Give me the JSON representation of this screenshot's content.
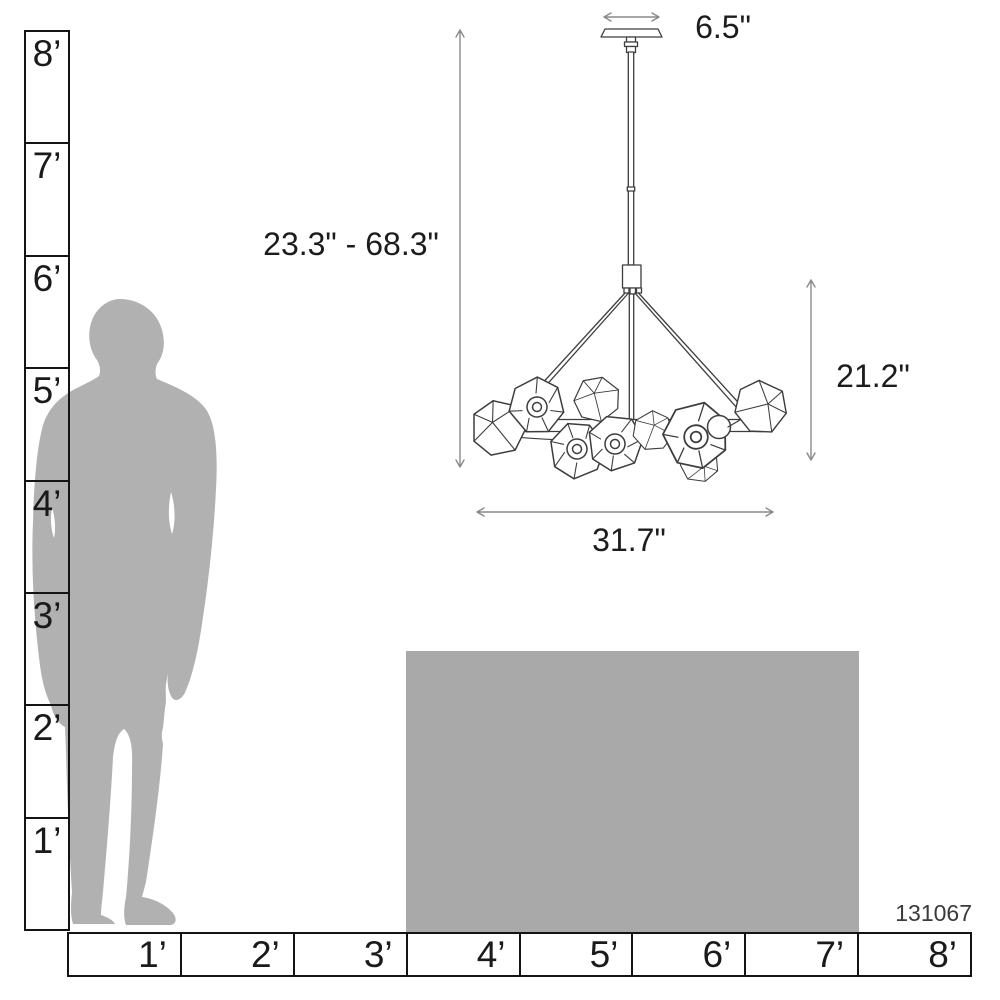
{
  "product": {
    "code": "131067"
  },
  "dimension_labels": {
    "canopy_width": "6.5\"",
    "overall_height_range": "23.3\" - 68.3\"",
    "body_height": "21.2\"",
    "body_width": "31.7\""
  },
  "vertical_ruler": {
    "labels": [
      "8’",
      "7’",
      "6’",
      "5’",
      "4’",
      "3’",
      "2’",
      "1’"
    ]
  },
  "horizontal_ruler": {
    "labels": [
      "1’",
      "2’",
      "3’",
      "4’",
      "5’",
      "6’",
      "7’",
      "8’"
    ]
  },
  "colors": {
    "silhouette_gray": "#b1b1b1",
    "table_gray": "#a9a9a9",
    "ruler_black": "#141414",
    "fixture_line": "#3d3d3d",
    "dimension_gray": "#8a8a8a",
    "text_dark": "#1c1c1c"
  }
}
